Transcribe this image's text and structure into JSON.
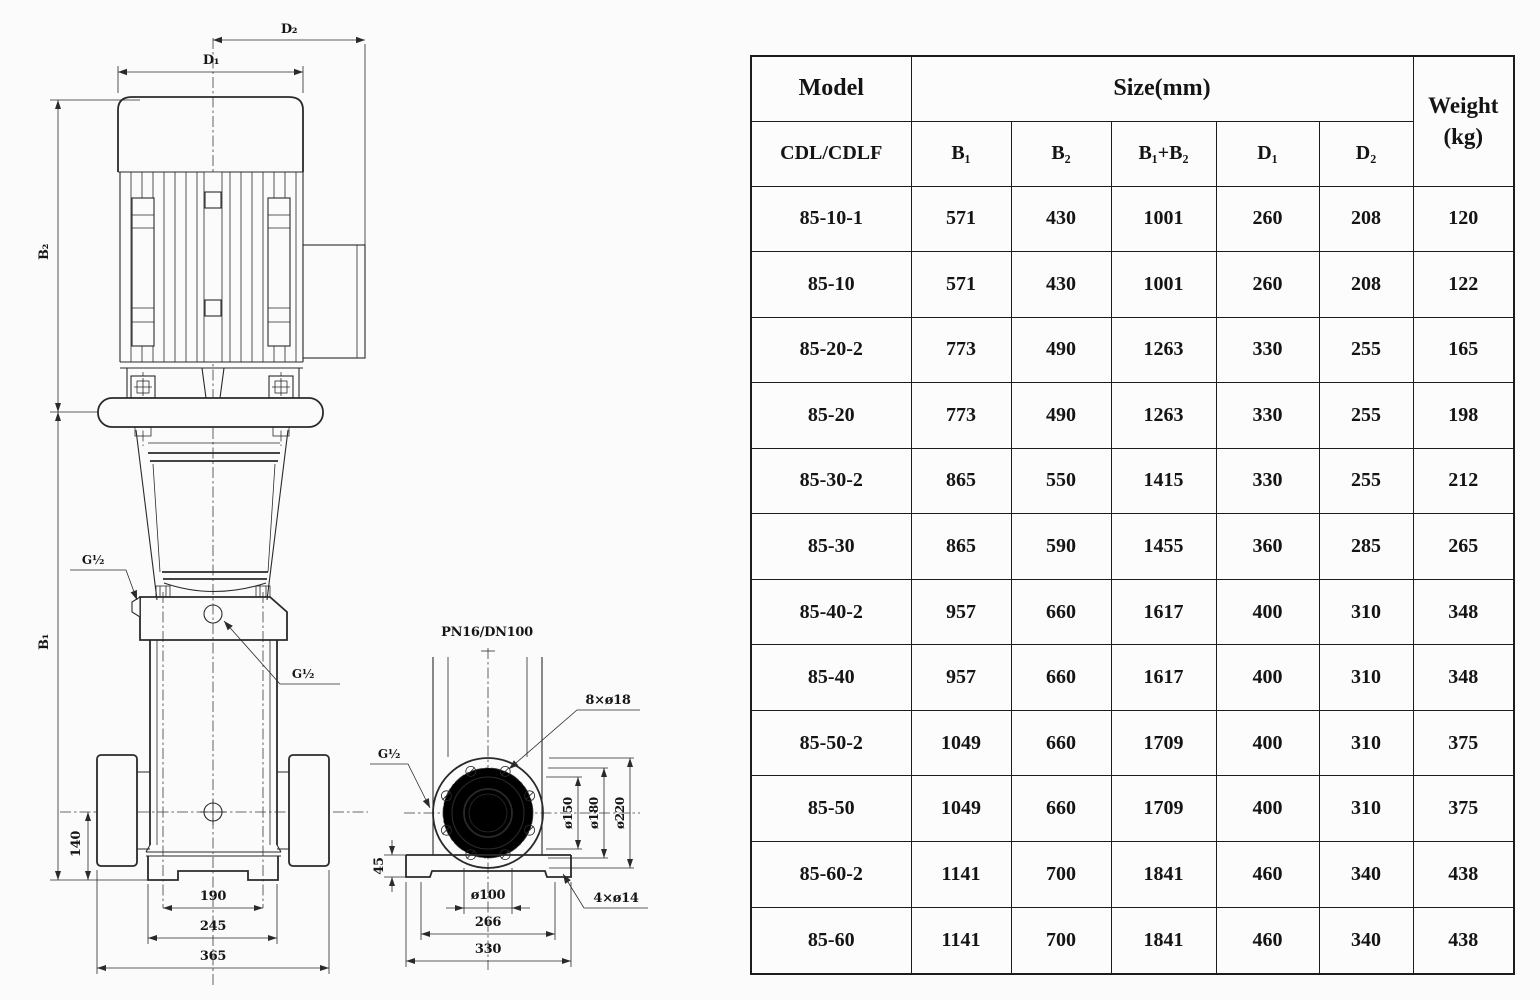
{
  "colors": {
    "line": "#2a2a2a",
    "background": "#fbfbfb",
    "table_border": "#1c1c1c",
    "text": "#141414"
  },
  "drawing": {
    "front_view": {
      "d2": "D₂",
      "d1": "D₁",
      "b2": "B₂",
      "b1": "B₁",
      "g_half_left": "G½",
      "g_half_right": "G½",
      "dim_140": "140",
      "dim_190": "190",
      "dim_245": "245",
      "dim_365": "365"
    },
    "flange_view": {
      "flange_spec": "PN16/DN100",
      "bolt_holes": "8×ø18",
      "g_half": "G½",
      "dia_150": "ø150",
      "dia_180": "ø180",
      "dia_220": "ø220",
      "dim_45": "45",
      "dia_100": "ø100",
      "dim_266": "266",
      "dim_330": "330",
      "base_holes": "4×ø14"
    }
  },
  "table": {
    "header": {
      "model": "Model",
      "model_series": "CDL/CDLF",
      "size_group": "Size(mm)",
      "weight_line1": "Weight",
      "weight_line2": "(kg)",
      "size_cols": [
        "B₁",
        "B₂",
        "B₁+B₂",
        "D₁",
        "D₂"
      ]
    },
    "rows": [
      [
        "85-10-1",
        "571",
        "430",
        "1001",
        "260",
        "208",
        "120"
      ],
      [
        "85-10",
        "571",
        "430",
        "1001",
        "260",
        "208",
        "122"
      ],
      [
        "85-20-2",
        "773",
        "490",
        "1263",
        "330",
        "255",
        "165"
      ],
      [
        "85-20",
        "773",
        "490",
        "1263",
        "330",
        "255",
        "198"
      ],
      [
        "85-30-2",
        "865",
        "550",
        "1415",
        "330",
        "255",
        "212"
      ],
      [
        "85-30",
        "865",
        "590",
        "1455",
        "360",
        "285",
        "265"
      ],
      [
        "85-40-2",
        "957",
        "660",
        "1617",
        "400",
        "310",
        "348"
      ],
      [
        "85-40",
        "957",
        "660",
        "1617",
        "400",
        "310",
        "348"
      ],
      [
        "85-50-2",
        "1049",
        "660",
        "1709",
        "400",
        "310",
        "375"
      ],
      [
        "85-50",
        "1049",
        "660",
        "1709",
        "400",
        "310",
        "375"
      ],
      [
        "85-60-2",
        "1141",
        "700",
        "1841",
        "460",
        "340",
        "438"
      ],
      [
        "85-60",
        "1141",
        "700",
        "1841",
        "460",
        "340",
        "438"
      ]
    ]
  }
}
